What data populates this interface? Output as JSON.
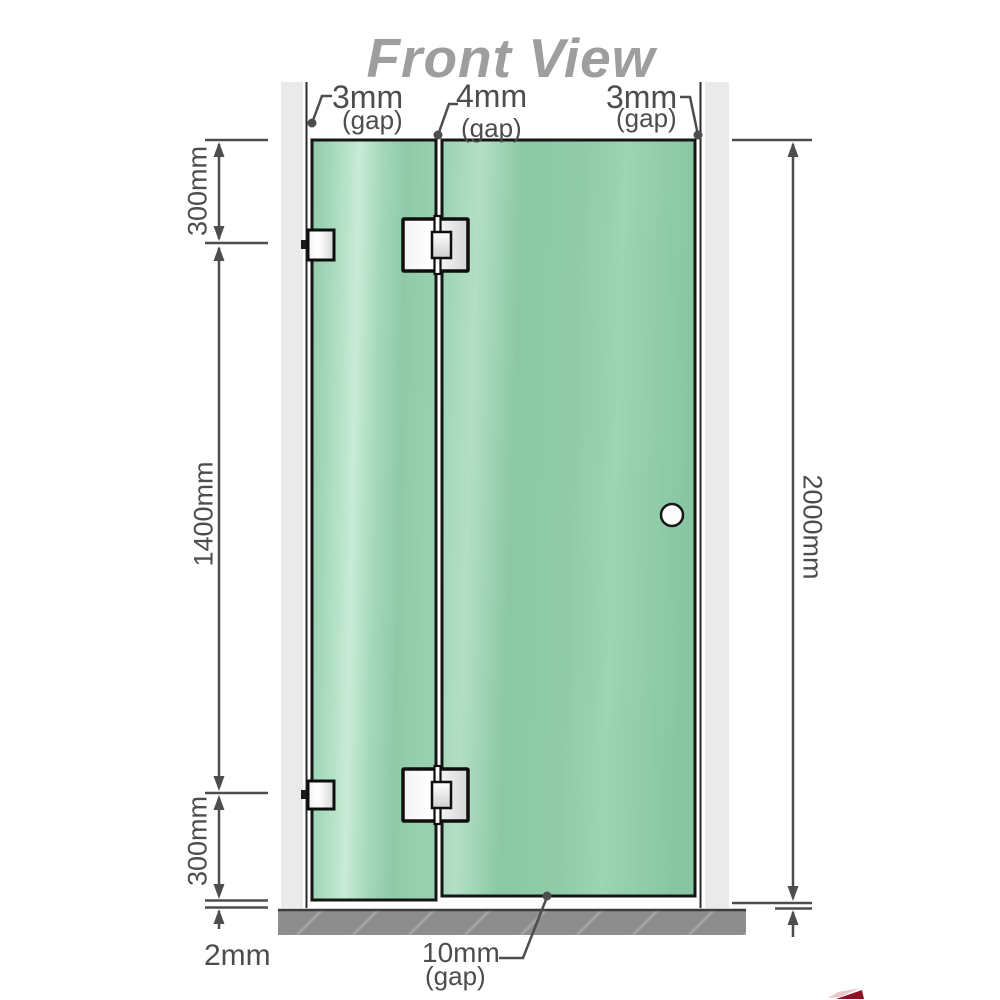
{
  "title": "Front View",
  "labels": {
    "gap_left": {
      "value": "3mm",
      "unit": "(gap)"
    },
    "gap_middle": {
      "value": "4mm",
      "unit": "(gap)"
    },
    "gap_right": {
      "value": "3mm",
      "unit": "(gap)"
    },
    "gap_bottom": {
      "value": "10mm",
      "unit": "(gap)"
    }
  },
  "dimensions": {
    "top_left": "300mm",
    "middle_left": "1400mm",
    "bottom_left": "300mm",
    "floor_gap": "2mm",
    "right_height": "2000mm"
  },
  "colors": {
    "glass_green": "#8fcaa8",
    "glass_highlight": "#c8ebd6",
    "wall_gray": "#eaeaea",
    "floor_gray": "#8d8d8d",
    "line_gray": "#4d4d4d",
    "title_gray": "#9e9e9e",
    "watermark_red": "#8d1324"
  }
}
